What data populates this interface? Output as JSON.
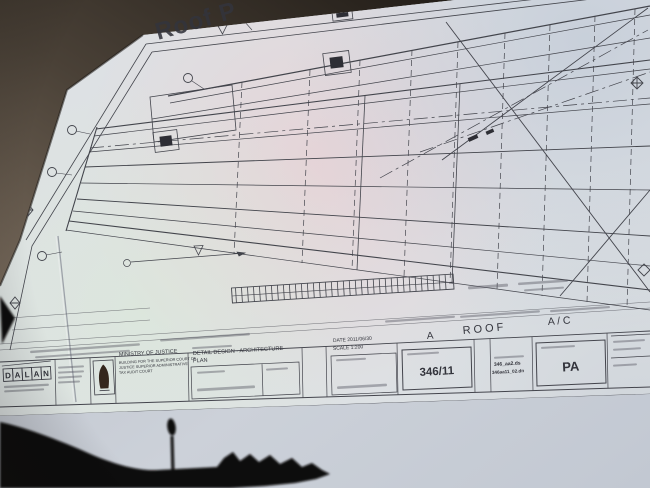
{
  "photo": {
    "subject": "architectural roof plan drawing projected at an angle",
    "title": {
      "text": "Roof P"
    }
  },
  "title_block": {
    "logo_letters": [
      "D",
      "A",
      "L",
      "A",
      "N"
    ],
    "ministry": {
      "name": "MINISTRY OF JUSTICE",
      "line1": "BUILDING FOR THE SUPERIOR COURT OF",
      "line2": "JUSTICE SUPERIOR ADMINISTRATIVE",
      "line3": "TAX AUDIT COURT"
    },
    "drawing_title": {
      "line1": "DETAIL DESIGN - ARCHITECTURE",
      "line2": "PLAN"
    },
    "date_label": "DATE 2011/06/30",
    "scale_label": "SCALE 1:200",
    "project_no": "346/11",
    "revision": "A",
    "sheet_name": "ROOF",
    "system_label": "A / C",
    "drawing_code": "PA",
    "file_line1": "346_aa2.ds",
    "file_line2": "346aa11_02.dn"
  },
  "colors": {
    "wall_dark": "#2a241e",
    "wall_light": "#6e6256",
    "screen": "#c6cbd4",
    "sheet": "#dde1e4",
    "tint_pink": "#ecc9cd",
    "tint_blue": "#b7c1d2",
    "tint_mint": "#dcead7",
    "ink": "#43444c",
    "silhouette": "#0b0908"
  }
}
